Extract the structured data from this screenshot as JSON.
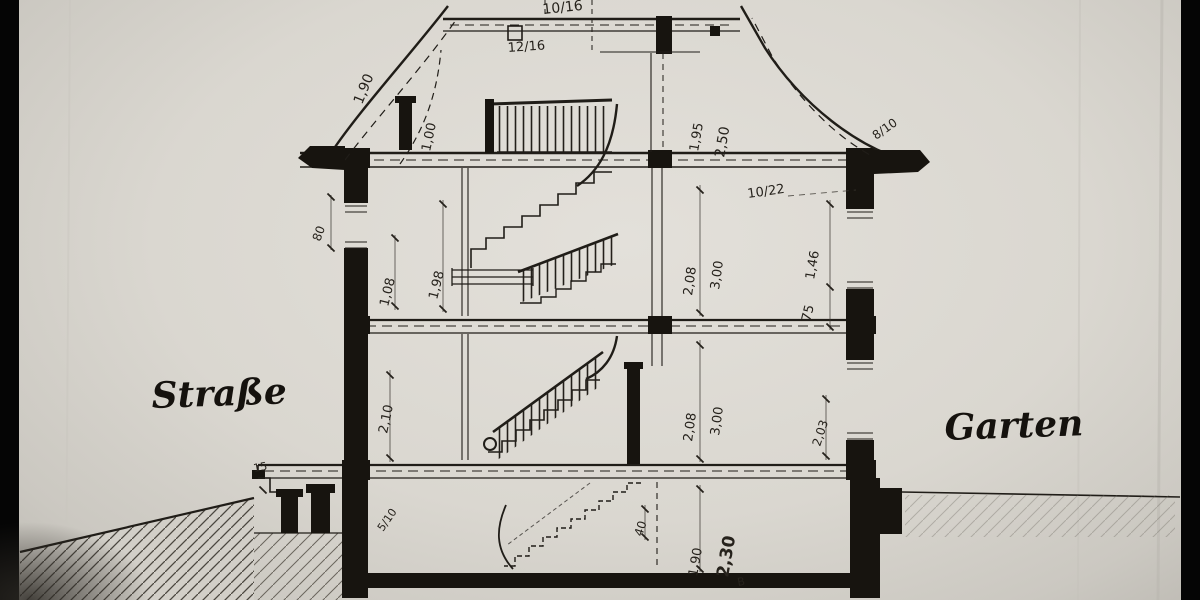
{
  "drawing": {
    "description_left": "Straße",
    "description_right": "Garten",
    "colors": {
      "paper": "#dad7d0",
      "ink": "#201d18",
      "letterbox": "#050505",
      "ground_hatch": "#4a463f"
    }
  },
  "labels": [
    {
      "id": "ridge-beam-size",
      "text": "10/16"
    },
    {
      "id": "purlin-size",
      "text": "12/16"
    },
    {
      "id": "roof-left-dim",
      "text": "1,90"
    },
    {
      "id": "roof-curve-dim",
      "text": "1,00"
    },
    {
      "id": "roof-right-dim-a",
      "text": "1,95"
    },
    {
      "id": "roof-right-dim-b",
      "text": "2,50"
    },
    {
      "id": "rafter-size",
      "text": "8/10"
    },
    {
      "id": "ceiling-beam-size",
      "text": "10/22"
    },
    {
      "id": "left-knee-wall-dim",
      "text": "80"
    },
    {
      "id": "left-sill-dim",
      "text": "1,08"
    },
    {
      "id": "left-room-dim",
      "text": "1,98"
    },
    {
      "id": "mid-clear-height",
      "text": "2,08"
    },
    {
      "id": "mid-storey-height",
      "text": "3,00"
    },
    {
      "id": "right-window-dim",
      "text": "1,46"
    },
    {
      "id": "right-parapet-dim",
      "text": "75"
    },
    {
      "id": "street-label",
      "text": "Straße"
    },
    {
      "id": "lower-left-dim",
      "text": "2,10"
    },
    {
      "id": "lower-clear-height",
      "text": "2,08"
    },
    {
      "id": "lower-storey-height",
      "text": "3,00"
    },
    {
      "id": "right-lower-dim",
      "text": "2,03"
    },
    {
      "id": "garden-label",
      "text": "Garten"
    },
    {
      "id": "entry-step-dim",
      "text": "15"
    },
    {
      "id": "joist-size",
      "text": "5/10"
    },
    {
      "id": "basement-step-dim",
      "text": "40"
    },
    {
      "id": "basement-clear-dim",
      "text": "1,90"
    },
    {
      "id": "basement-height-dim",
      "text": "2,30"
    },
    {
      "id": "basement-mark",
      "text": "B"
    }
  ]
}
